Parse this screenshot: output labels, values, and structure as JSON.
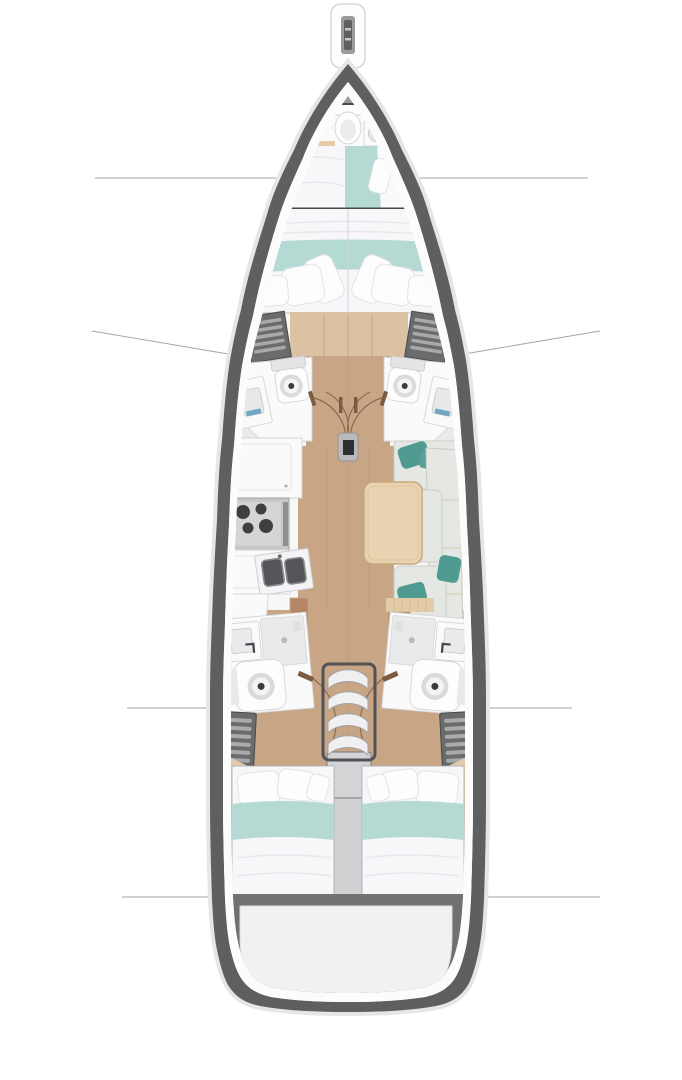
{
  "meta": {
    "title": "Sailing yacht interior floor plan (top view, bow up)",
    "view": "top-down",
    "text_on_image": "none"
  },
  "colors": {
    "hull": "#5e5f61",
    "hull_shadow": "#e6e6e8",
    "deck": "#fcfcfd",
    "interior": "#f7f7f8",
    "bow_deck": "#9a9b9d",
    "floor_wood": "#c8a685",
    "floor_wood_light": "#dac2a2",
    "floor_seam": "#b28f72",
    "wood_trim": "#e5cca9",
    "cabinet_brown": "#b58565",
    "bed_white": "#f7f7f9",
    "pillow_stroke": "#e3e3e8",
    "blanket_teal": "#b5d9d3",
    "accent_teal": "#4f9a91",
    "settee": "#e4e7e2",
    "settee_seam": "#c9ccc7",
    "table_wood": "#ead3b0",
    "table_border": "#c7a87c",
    "counter_white": "#fafafb",
    "counter_border": "#d6d6d9",
    "appliance": "#c6c7c9",
    "burner": "#3e3f41",
    "basin": "#54555a",
    "shower": "#e9ebea",
    "fixture_border": "#d4d4d7",
    "locker": "#6a6b6d",
    "locker_slat": "#a8a9ab",
    "wall": "#48494b",
    "door_arc": "#8a6b50",
    "door_leaf": "#7b5c43",
    "stair_frame": "#515255",
    "stair_step": "#f0f0f2",
    "stair_platform": "#d3d4d6",
    "engine_box": "#d0d1d3",
    "transom": "#717274",
    "stern_dark": "#6f7072",
    "line_ref": "#a6a6a8",
    "sink_accent_blue": "#6fa7c2"
  },
  "legend": {
    "bowsprit": "bowsprit with anchor roller channel",
    "forepeak_cabin": "forepeak compartment: toilet, washbasin, wood shelf, single berth with teal runner",
    "forward_cabin": "forward V-berth double cabin, teal blanket band, pillows aft",
    "forward_heads": "two symmetric shower heads amidships with toilets, basins and swing doors",
    "mast_post": "mast compression post between double doors",
    "galley": "port galley: upper cabinet, 4-burner cooktop, lower cabinets, twin sinks",
    "salon": "starboard salon: U-shaped settee, teal accent cushions, rectangular wood table",
    "aft_heads": "two symmetric aft heads with basin, shower pan and toilet",
    "companionway": "central companionway with 4 curved steps and landing platform",
    "lockers": "slatted louver lockers forward and aft on both sides",
    "aft_cabins": "two aft double cabins, pillows forward, teal blanket band",
    "stern": "transom beam and rounded swim-platform area",
    "reference_lines": "four thin gray section lines crossing hull at forward berth, midship heads (slanted), aft heads and transom"
  }
}
